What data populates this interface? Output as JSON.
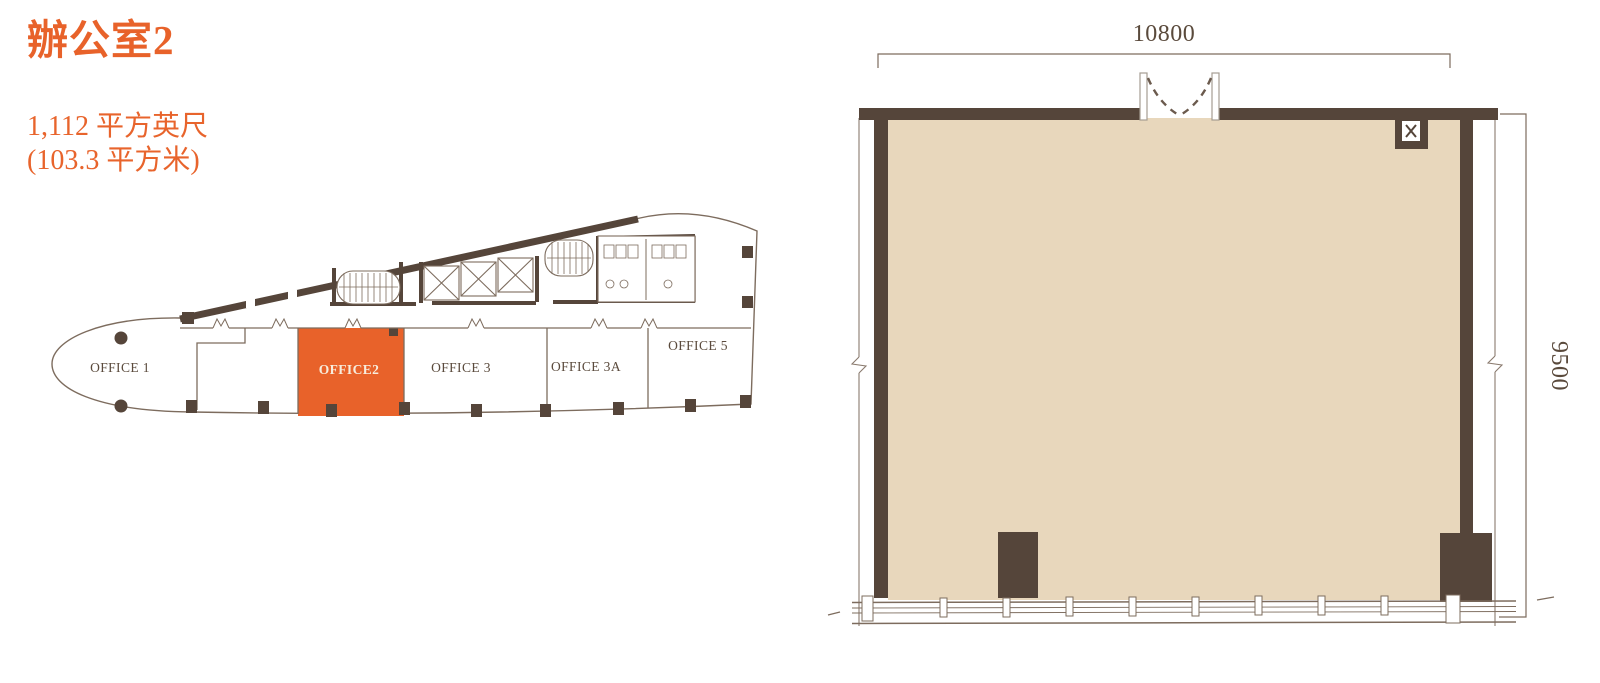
{
  "header": {
    "title": "辦公室2",
    "area_sqft": "1,112 平方英尺",
    "area_sqm": "(103.3 平方米)"
  },
  "keyplan": {
    "offices": [
      {
        "label": "OFFICE 1",
        "highlighted": false
      },
      {
        "label": "OFFICE2",
        "highlighted": true
      },
      {
        "label": "OFFICE 3",
        "highlighted": false
      },
      {
        "label": "OFFICE 3A",
        "highlighted": false
      },
      {
        "label": "OFFICE 5",
        "highlighted": false
      }
    ]
  },
  "floorplan": {
    "unit": "OFFICE2",
    "dim_width": "10800",
    "dim_height": "9500"
  },
  "colors": {
    "accent_orange": "#E8622A",
    "wall_dark": "#55453A",
    "floor_beige": "#E8D7BC",
    "line_brown": "#7D6C5E",
    "label_brown": "#5A4A3C"
  }
}
